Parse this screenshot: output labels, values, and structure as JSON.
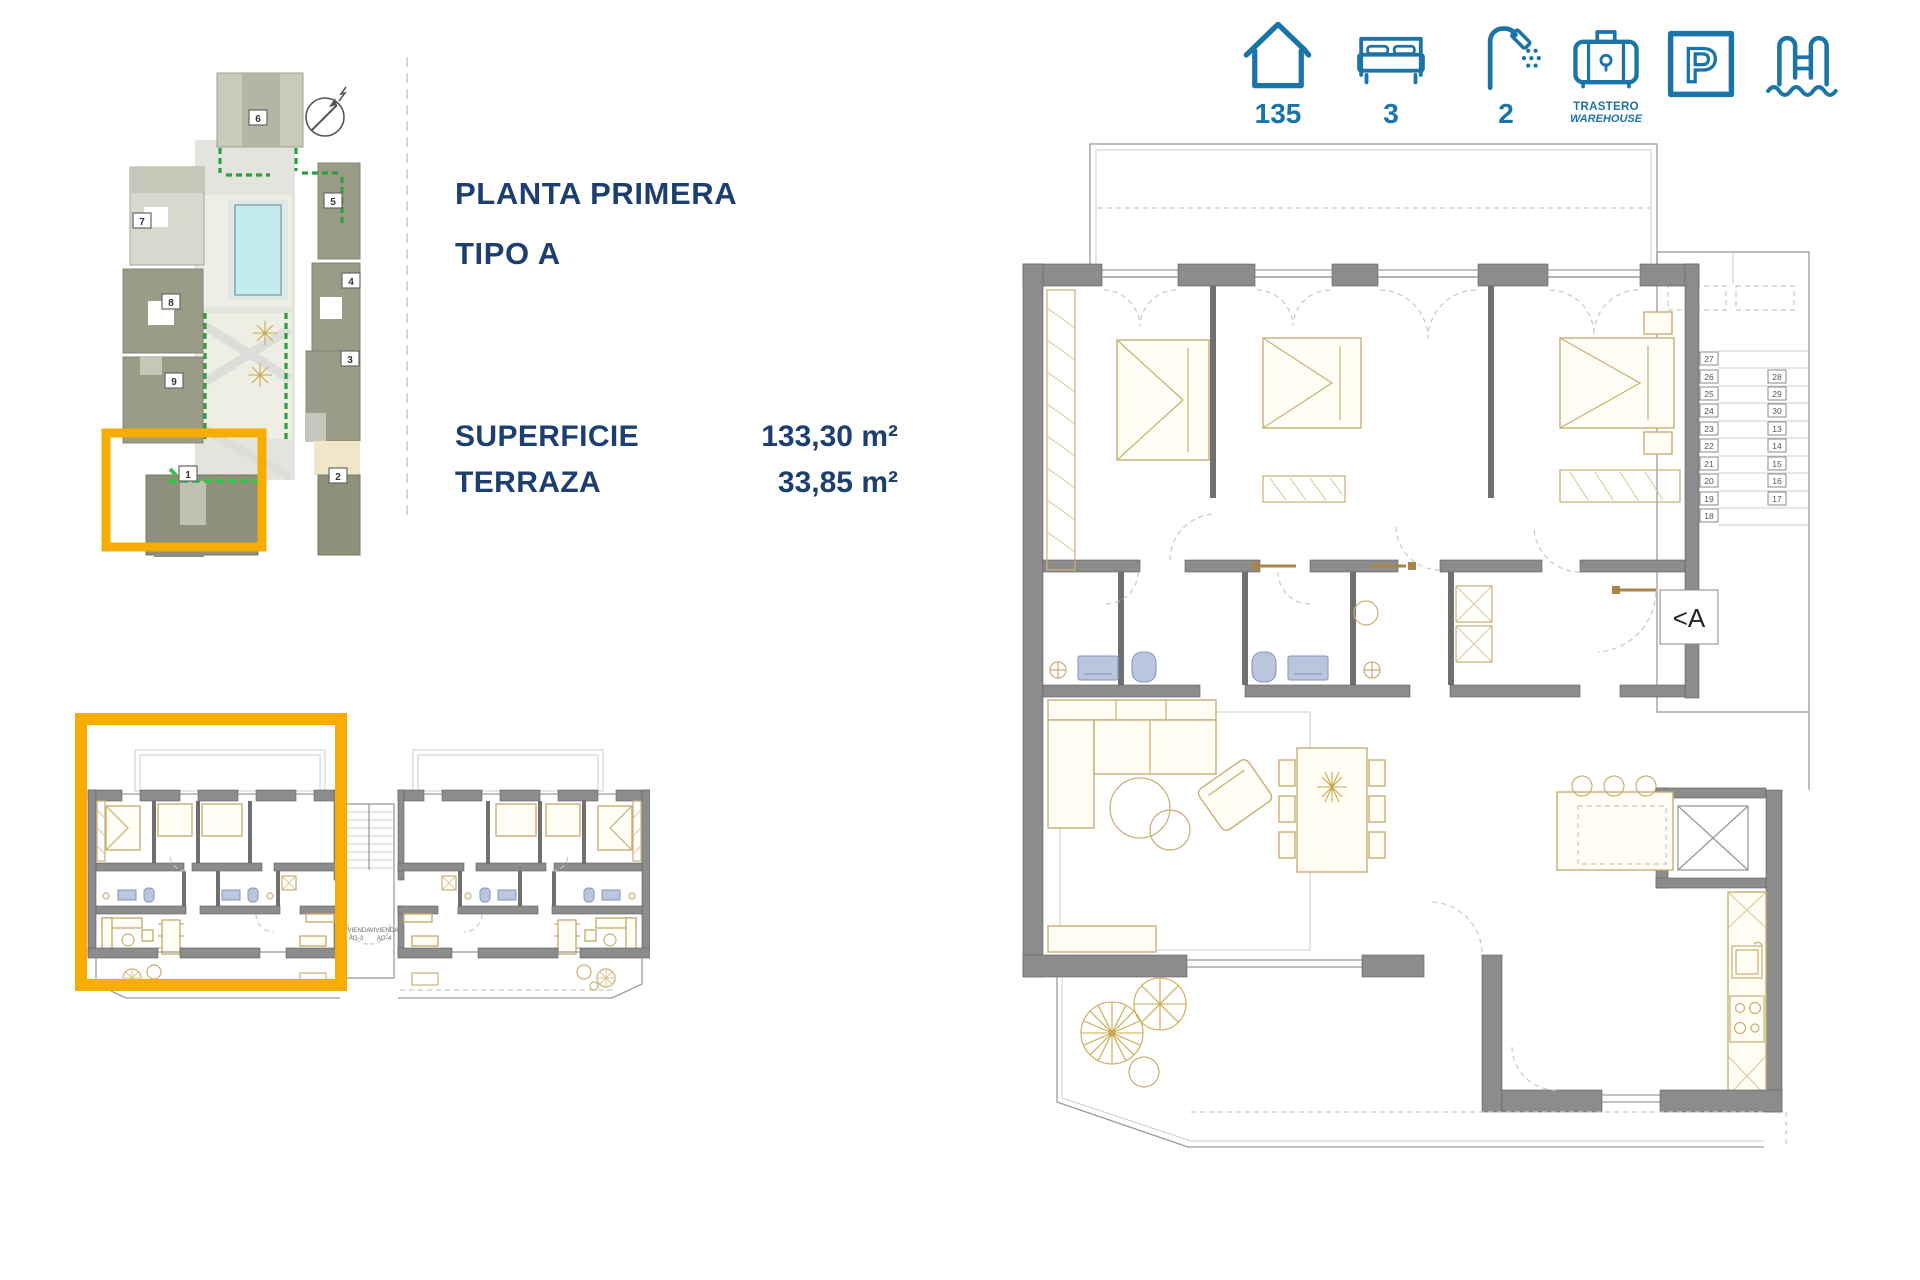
{
  "header": {
    "amenities": [
      {
        "icon": "house",
        "value": "135"
      },
      {
        "icon": "bed",
        "value": "3"
      },
      {
        "icon": "shower",
        "value": "2"
      },
      {
        "icon": "warehouse",
        "label_top": "TRASTERO",
        "label_bottom": "WAREHOUSE"
      },
      {
        "icon": "parking",
        "glyph": "P"
      },
      {
        "icon": "pool"
      }
    ]
  },
  "info": {
    "title": "PLANTA PRIMERA",
    "subtitle": "TIPO A",
    "rows": [
      {
        "label": "SUPERFICIE",
        "value": "133,30 m²"
      },
      {
        "label": "TERRAZA",
        "value": "33,85 m²"
      }
    ]
  },
  "site_plan": {
    "building_numbers": [
      "1",
      "2",
      "3",
      "4",
      "5",
      "6",
      "7",
      "8",
      "9"
    ]
  },
  "dual_plan": {
    "left_unit_line1": "VIVIENDA",
    "left_unit_line2": "AG-3",
    "right_unit_line1": "VIVIENDA",
    "right_unit_line2": "AG-4"
  },
  "main_plan": {
    "entrance_label": "<A",
    "storage_left": [
      "27",
      "26",
      "25",
      "24",
      "23",
      "22",
      "21",
      "20",
      "19",
      "18"
    ],
    "storage_right": [
      "28",
      "29",
      "30",
      "13",
      "14",
      "15",
      "16",
      "17"
    ]
  },
  "colors": {
    "accent_blue": "#1B74A8",
    "navy": "#1D3F70",
    "highlight_orange": "#F7AD00",
    "wall_gray": "#8C8C8C"
  }
}
